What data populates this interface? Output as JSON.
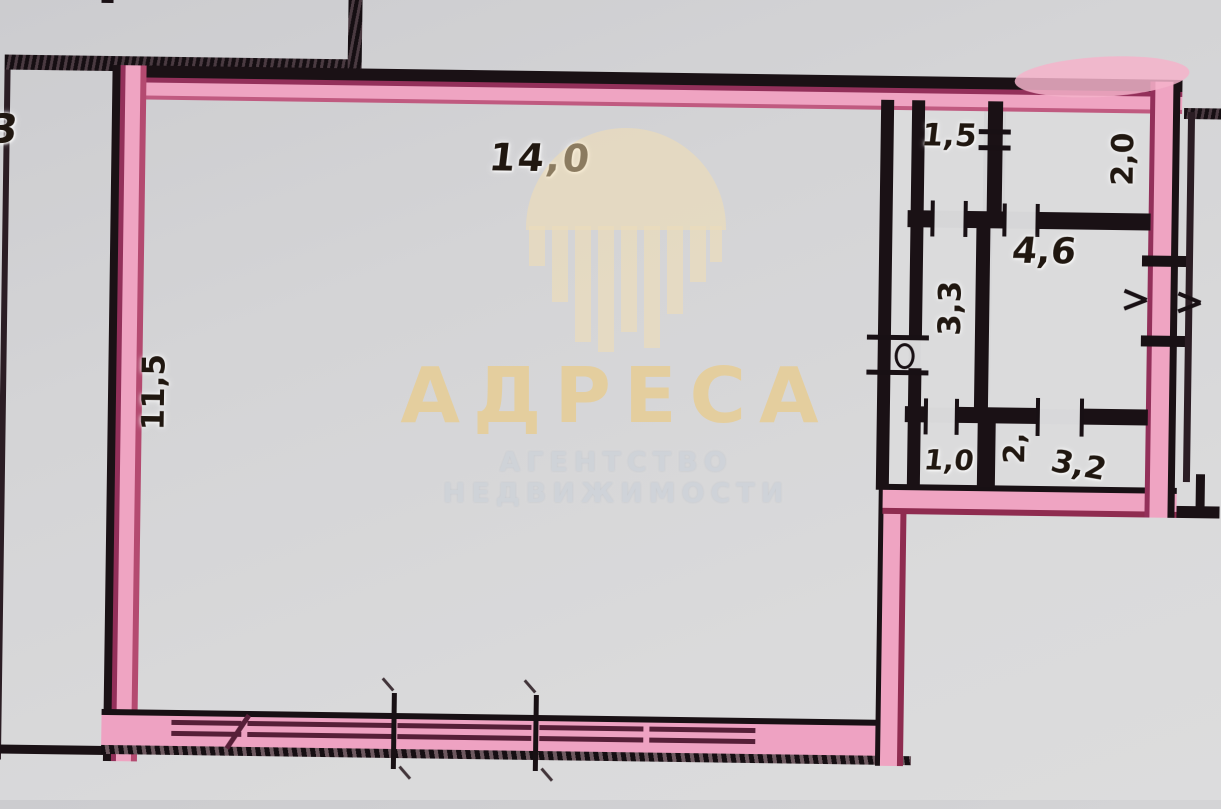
{
  "watermark": {
    "brand": "АДРЕСА",
    "tagline": "АГЕНТСТВО НЕДВИЖИМОСТИ",
    "logo": "building-skyline-circle",
    "brand_color": "#e8cd92",
    "tagline_color": "#cfd3d9"
  },
  "plan": {
    "type": "floor-plan",
    "highlight_color": "#efa4c2",
    "ink_color": "#1a1115",
    "paper_color": "#d5d5d7",
    "labels": [
      {
        "text": "14,0",
        "orientation": "horizontal"
      },
      {
        "text": "11,5",
        "orientation": "vertical"
      },
      {
        "text": "1,5",
        "orientation": "horizontal"
      },
      {
        "text": "2,0",
        "orientation": "vertical"
      },
      {
        "text": "4,6",
        "orientation": "horizontal"
      },
      {
        "text": "3,3",
        "orientation": "vertical"
      },
      {
        "text": "1,0",
        "orientation": "horizontal"
      },
      {
        "text": "2,",
        "orientation": "vertical"
      },
      {
        "text": "3,2",
        "orientation": "horizontal"
      },
      {
        "text": "3",
        "orientation": "horizontal"
      }
    ]
  }
}
